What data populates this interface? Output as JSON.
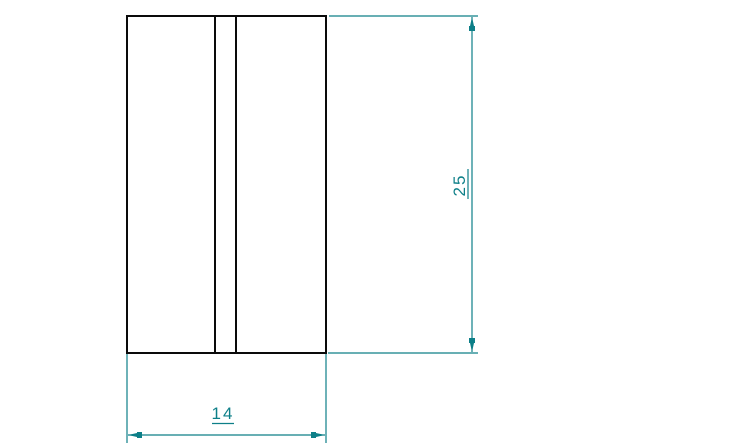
{
  "dimensions": {
    "height_label": "25",
    "width_label": "14"
  },
  "colors": {
    "background": "#ffffff",
    "outline": "#0a0a0a",
    "dimension": "#0d7f88"
  }
}
